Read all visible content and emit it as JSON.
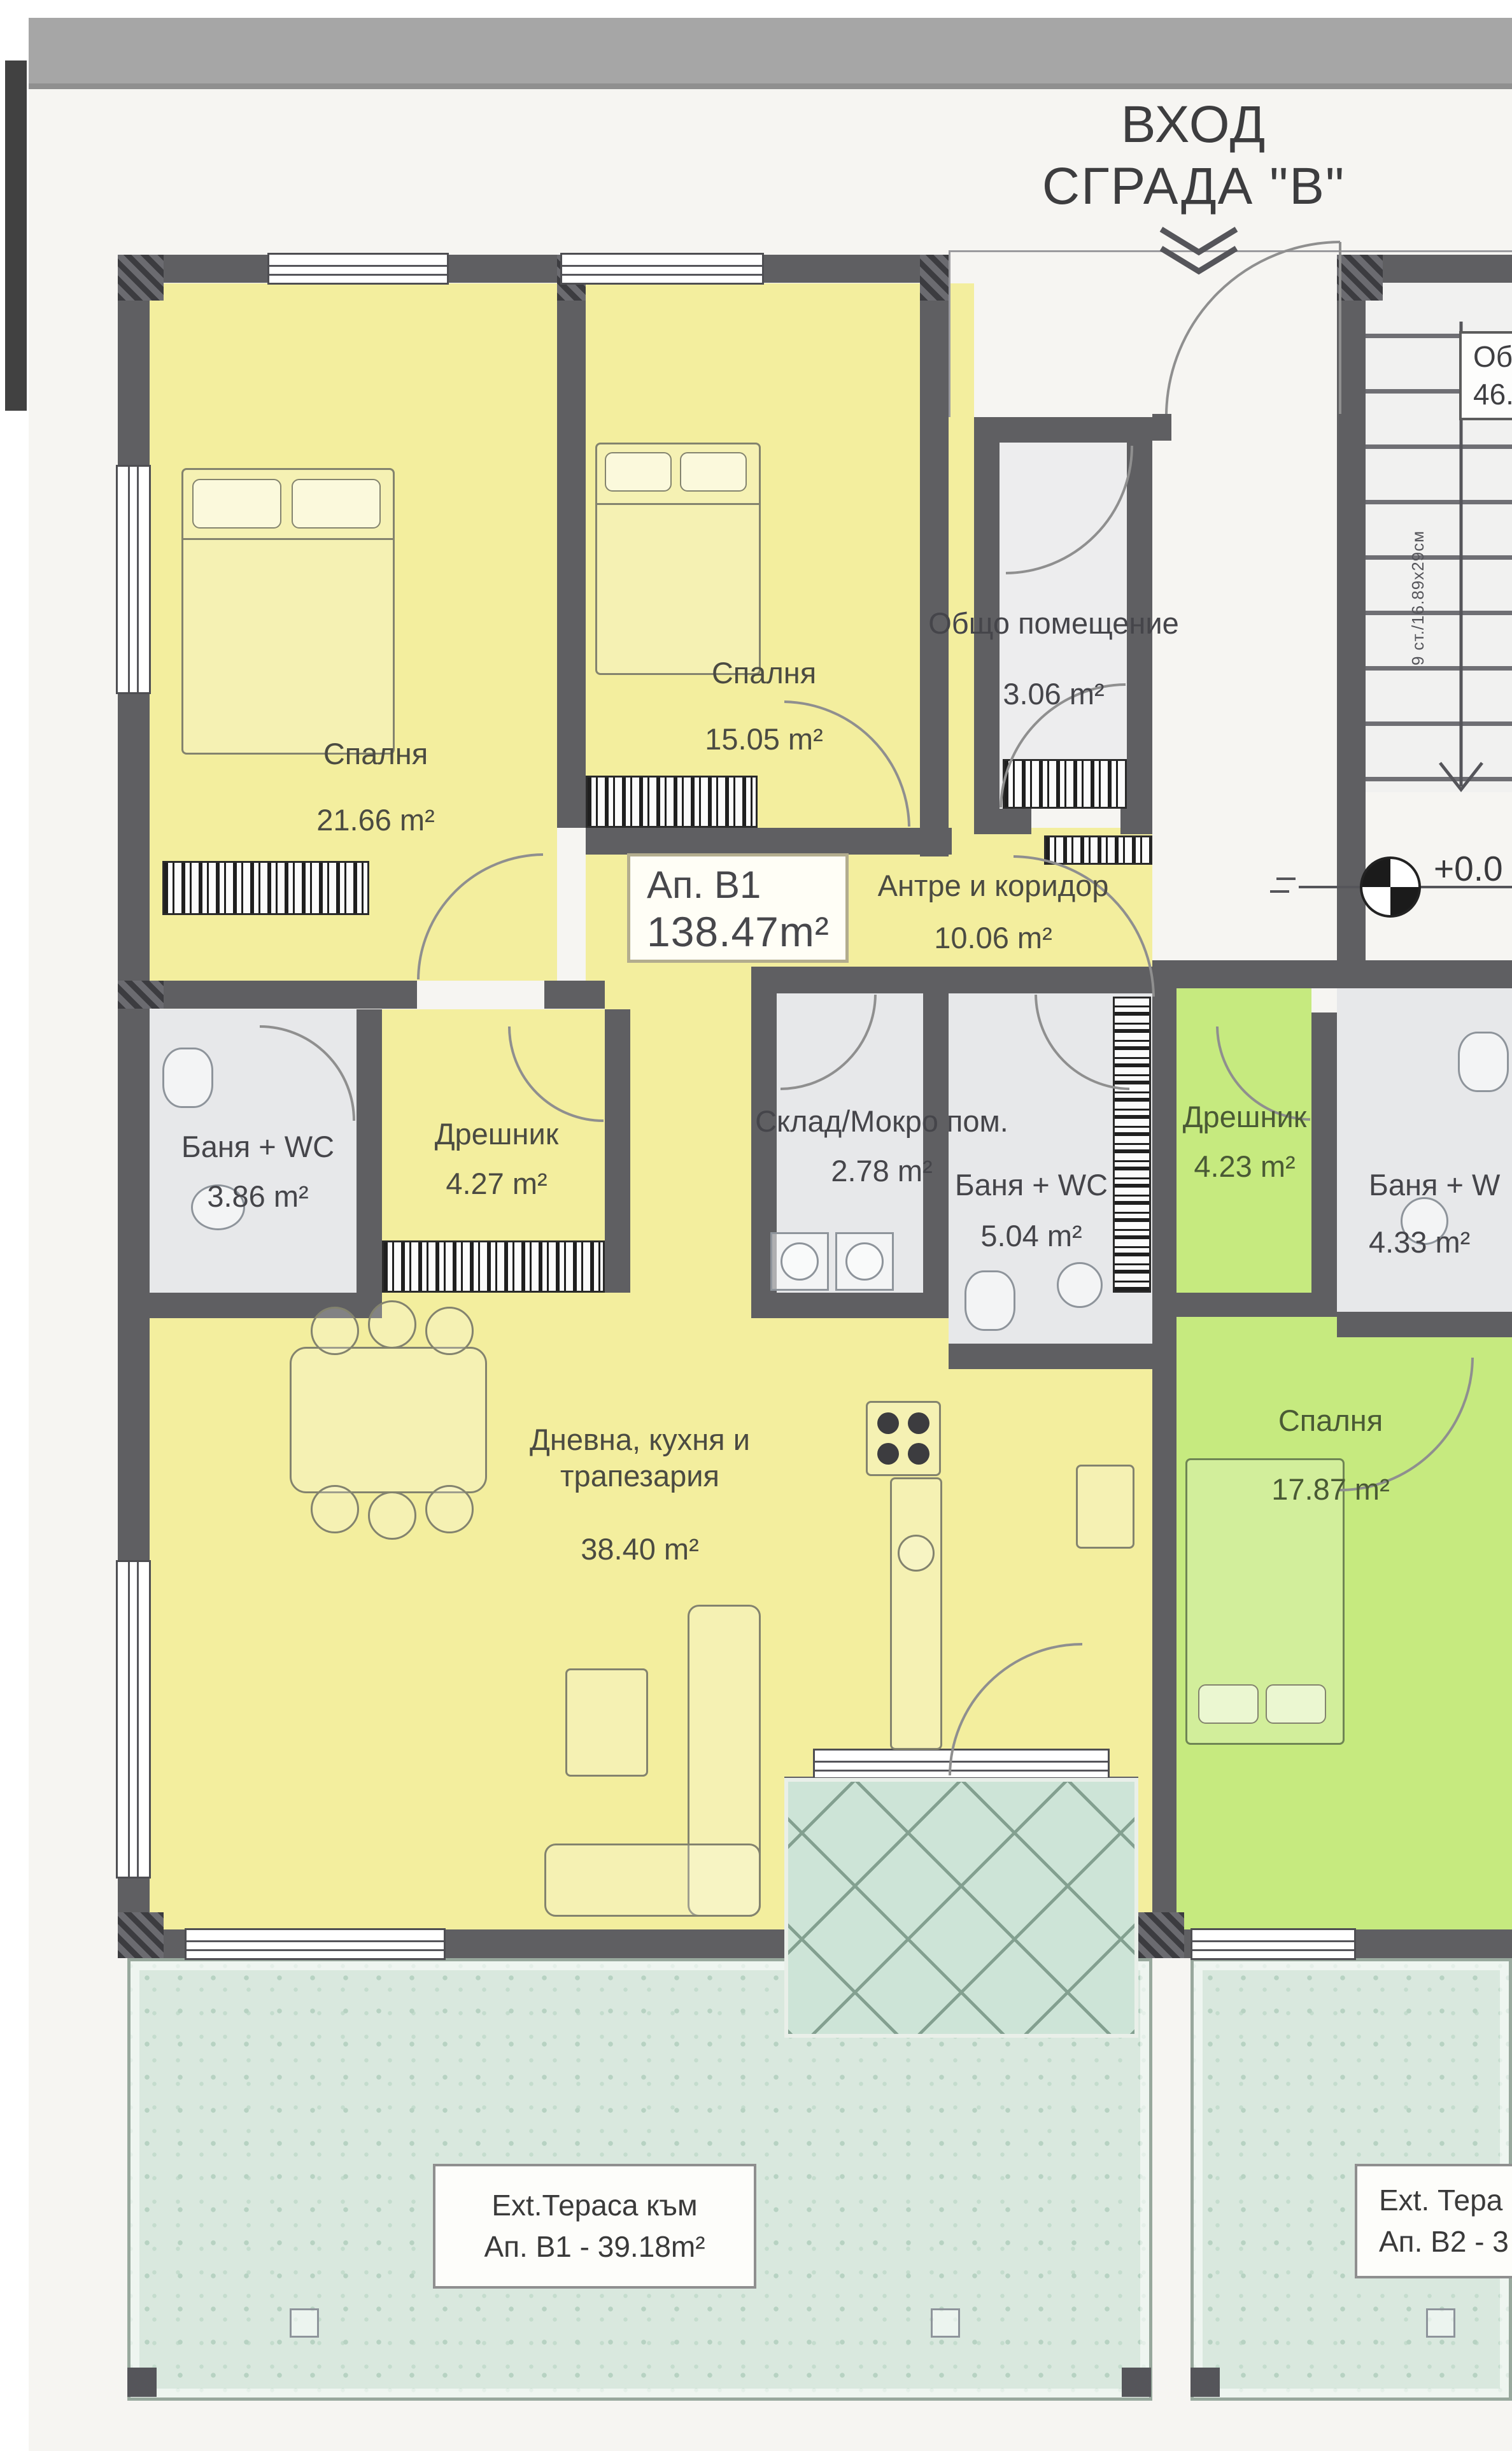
{
  "header": {
    "entrance_title_line1": "ВХОД",
    "entrance_title_line2": "СГРАДА \"В\""
  },
  "apartment_box": {
    "name": "Ап. В1",
    "area": "138.47m²"
  },
  "rooms": [
    {
      "name": "Спалня",
      "area": "21.66 m²"
    },
    {
      "name": "Спалня",
      "area": "15.05 m²"
    },
    {
      "name": "Общо помещение",
      "area": "3.06 m²"
    },
    {
      "name": "Антре и коридор",
      "area": "10.06 m²"
    },
    {
      "name": "Баня + WC",
      "area": "3.86 m²"
    },
    {
      "name": "Дрешник",
      "area": "4.27 m²"
    },
    {
      "name": "Склад/Мокро пом.",
      "area": "2.78 m²"
    },
    {
      "name": "Баня + WC",
      "area": "5.04 m²"
    },
    {
      "name": "Дневна, кухня и\nтрапезария",
      "area": "38.40 m²"
    },
    {
      "name": "Дрешник",
      "area": "4.23 m²"
    },
    {
      "name": "Баня + W",
      "area": "4.33 m²"
    },
    {
      "name": "Спалня",
      "area": "17.87 m²"
    }
  ],
  "terrace_boxes": [
    {
      "line1": "Ext.Тераса към",
      "line2": "Ап. В1 - 39.18m²"
    },
    {
      "line1": "Ext. Тера",
      "line2": "Ап. В2 - 3"
    }
  ],
  "common_parts_box": {
    "line1": "Общ",
    "line2": "46.3"
  },
  "stairs_note": "9 ст./16.89х29см",
  "level_mark": "+0.0",
  "colors": {
    "apartment_b1_fill": "#f3ee9e",
    "apartment_b2_fill": "#c6ea7f",
    "common_area_fill": "#e7e8ea",
    "wall": "#5f5f62",
    "terrace_fill": "#d9e8de"
  }
}
